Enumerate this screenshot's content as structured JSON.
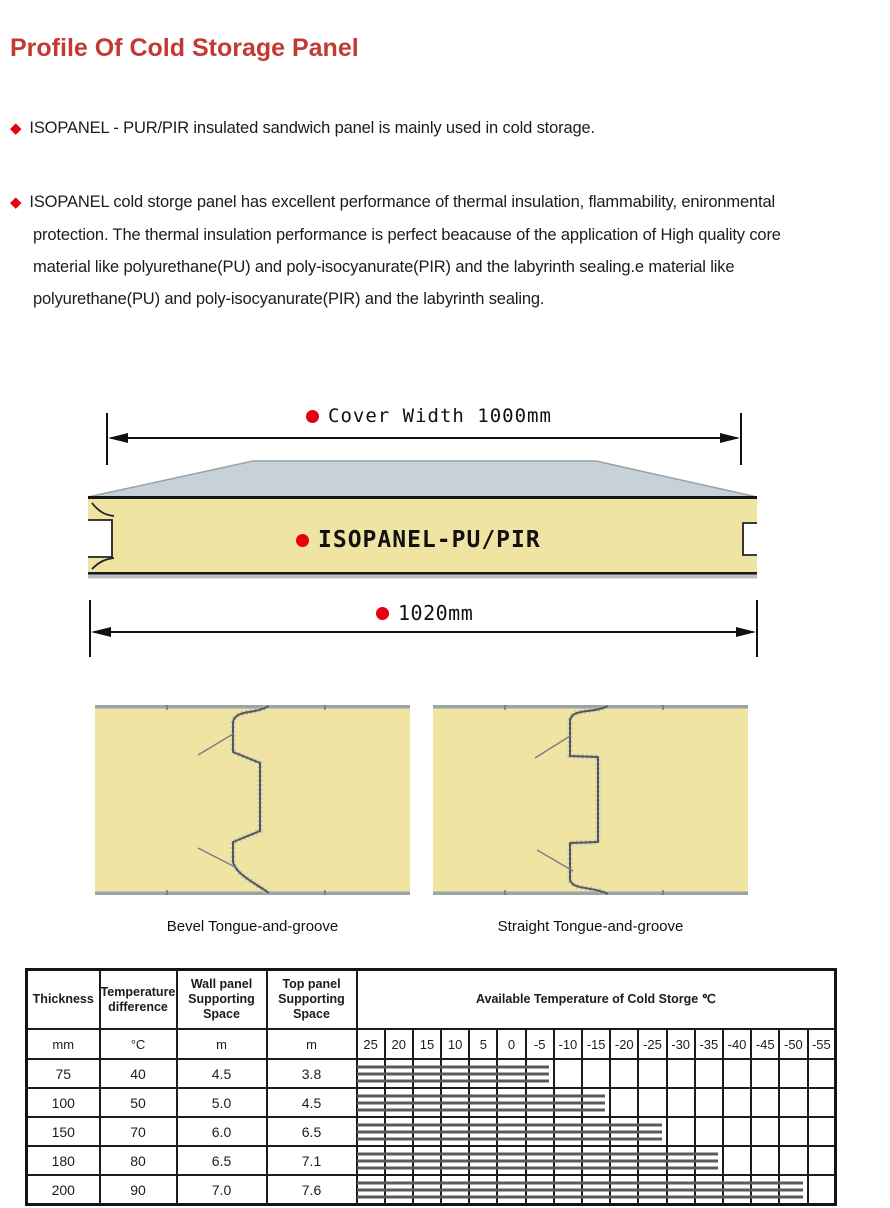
{
  "colors": {
    "title_red": "#c23a33",
    "accent_red": "#e60012",
    "panel_yellow": "#f0e4a2",
    "sheet_gray": "#c7d1d8",
    "bar_gray": "#5a5a5a"
  },
  "title": "Profile Of Cold Storage Panel",
  "bullets": [
    {
      "text": "ISOPANEL - PUR/PIR insulated sandwich panel is mainly used in cold storage."
    },
    {
      "lines": [
        "ISOPANEL cold storge panel has excellent performance of thermal insulation, flammability, enironmental",
        "protection. The thermal insulation performance is perfect beacause of the application of High quality core",
        "material like polyurethane(PU) and poly-isocyanurate(PIR)  and the labyrinth sealing.e material like",
        "polyurethane(PU) and poly-isocyanurate(PIR)  and the labyrinth sealing."
      ]
    }
  ],
  "diagram": {
    "cover_width_label": "Cover Width 1000mm",
    "panel_label": "ISOPANEL-PU/PIR",
    "bottom_width_label": "1020mm"
  },
  "figures": [
    {
      "caption": "Bevel Tongue-and-groove"
    },
    {
      "caption": "Straight Tongue-and-groove"
    }
  ],
  "table": {
    "headers": [
      "Thickness",
      "Temperature difference",
      "Wall panel Supporting Space",
      "Top panel Supporting Space"
    ],
    "wide_header": "Available Temperature of Cold Storge ℃",
    "units": [
      "mm",
      "°C",
      "m",
      "m"
    ],
    "temp_columns": [
      "25",
      "20",
      "15",
      "10",
      "5",
      "0",
      "-5",
      "-10",
      "-15",
      "-20",
      "-25",
      "-30",
      "-35",
      "-40",
      "-45",
      "-50",
      "-55"
    ],
    "rows": [
      {
        "thickness": "75",
        "temp_difference": "40",
        "wall_span": "4.5",
        "top_span": "3.8",
        "temp_range_cols": 7,
        "available_to": "-5"
      },
      {
        "thickness": "100",
        "temp_difference": "50",
        "wall_span": "5.0",
        "top_span": "4.5",
        "temp_range_cols": 9,
        "available_to": "-15"
      },
      {
        "thickness": "150",
        "temp_difference": "70",
        "wall_span": "6.0",
        "top_span": "6.5",
        "temp_range_cols": 11,
        "available_to": "-25"
      },
      {
        "thickness": "180",
        "temp_difference": "80",
        "wall_span": "6.5",
        "top_span": "7.1",
        "temp_range_cols": 13,
        "available_to": "-35"
      },
      {
        "thickness": "200",
        "temp_difference": "90",
        "wall_span": "7.0",
        "top_span": "7.6",
        "temp_range_cols": 16,
        "available_to": "-50"
      }
    ]
  }
}
